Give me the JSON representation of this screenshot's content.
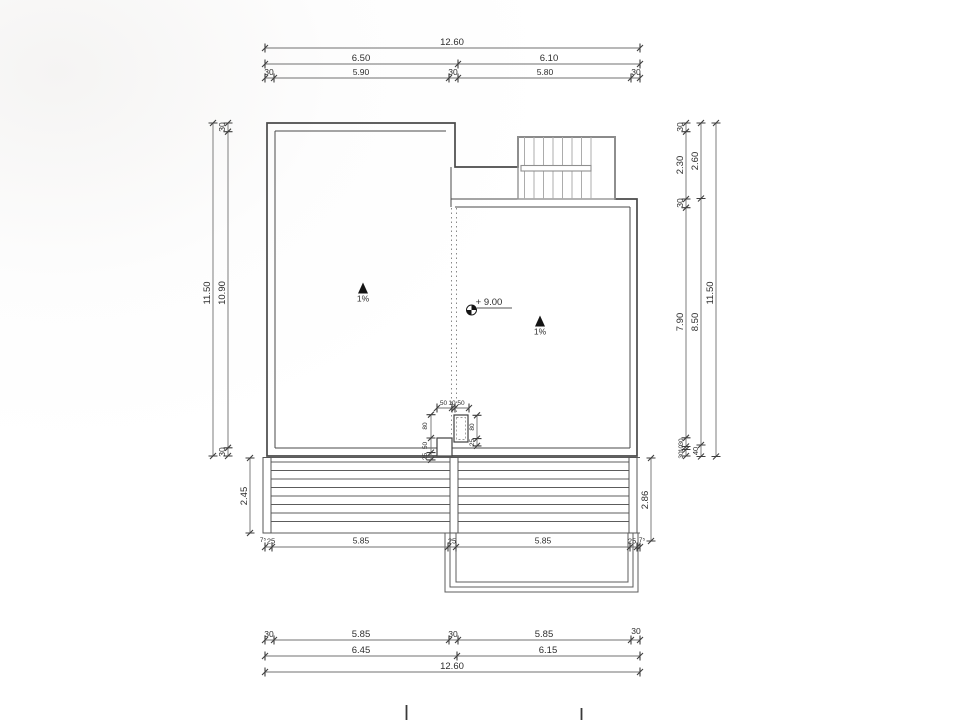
{
  "meta": {
    "drawing_type": "roof plan with terrace and stairs"
  },
  "colors": {
    "line": "#4a4a4a",
    "stair_line": "#949494",
    "background": "#ffffff",
    "annotation": "#141414"
  },
  "labels": {
    "level": "+ 9.00",
    "slope_left": "1%",
    "slope_right": "1%"
  },
  "dims": {
    "top_total": "12.60",
    "top_mid": [
      "6.50",
      "6.10"
    ],
    "top_detail": [
      "30",
      "5.90",
      "30",
      "5.80",
      "30"
    ],
    "left_outer": "11.50",
    "left_inner": [
      "30",
      "10.90",
      "30"
    ],
    "left_deck": "2.45",
    "right_inner": [
      "30",
      "2.30",
      "30",
      "7.90",
      "30",
      "10",
      "30"
    ],
    "right_mid": [
      "2.60",
      "8.50",
      "40"
    ],
    "right_outer": "11.50",
    "right_deck": "2.86",
    "box_top": [
      "50",
      "10",
      "50"
    ],
    "box_left": [
      "80",
      "50",
      "25"
    ],
    "box_right": [
      "80",
      "25"
    ],
    "bottom_post": [
      "7⁵",
      "25",
      "5.85",
      "25",
      "5.85",
      "25",
      "7⁵"
    ],
    "bottom_detail": [
      "30",
      "5.85",
      "30",
      "5.85",
      "30"
    ],
    "bottom_mid": [
      "6.45",
      "6.15"
    ],
    "bottom_total": "12.60"
  }
}
